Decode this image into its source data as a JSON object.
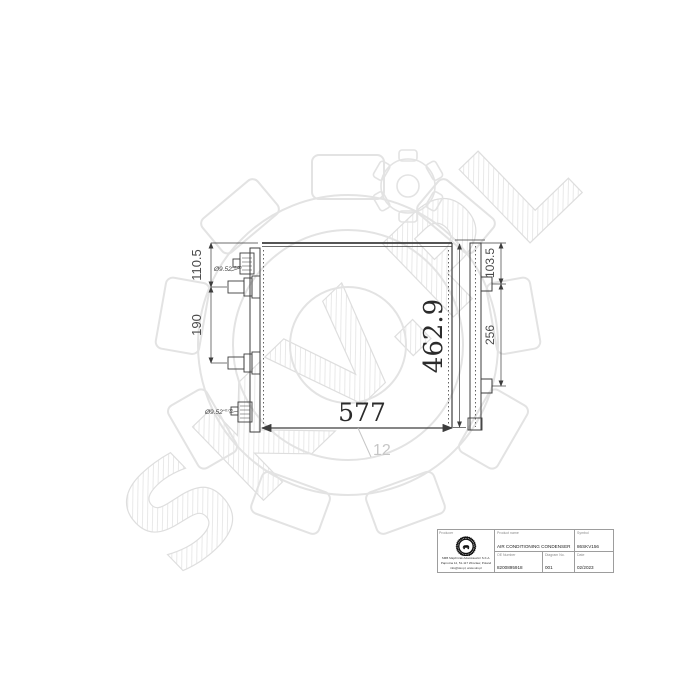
{
  "watermark": {
    "text": "SKV.PL",
    "color": "#e2e2e2"
  },
  "drawing": {
    "dims": {
      "width": "577",
      "height": "462.9",
      "left_top_offset": "110.5",
      "left_port_spacing": "190",
      "right_top_offset": "103.5",
      "right_bracket_spacing": "256",
      "depth": "12",
      "port_top_diameter": "Ø9.52",
      "port_top_tolerance": "+0.05",
      "port_bottom_diameter": "Ø9.52",
      "port_bottom_tolerance": "+0.05"
    }
  },
  "title_block": {
    "producer_label": "Producer",
    "producer_name": "SMB Majchrzak Adamkiewicz S.K.A.",
    "producer_address": "Paprotna 12, 51-117 Wroclaw, Poland",
    "producer_contact": "info@skv.pl, www.skv.pl",
    "product_name_label": "Product name",
    "product_name": "AIR CONDITIONING CONDENSER",
    "symbol_label": "Symbol",
    "symbol": "86SKV156",
    "oe_label": "OE Number",
    "oe_number": "8200895918",
    "diagram_label": "Diagram No.",
    "diagram_no": "001",
    "date_label": "Date",
    "date": "02/2023"
  }
}
